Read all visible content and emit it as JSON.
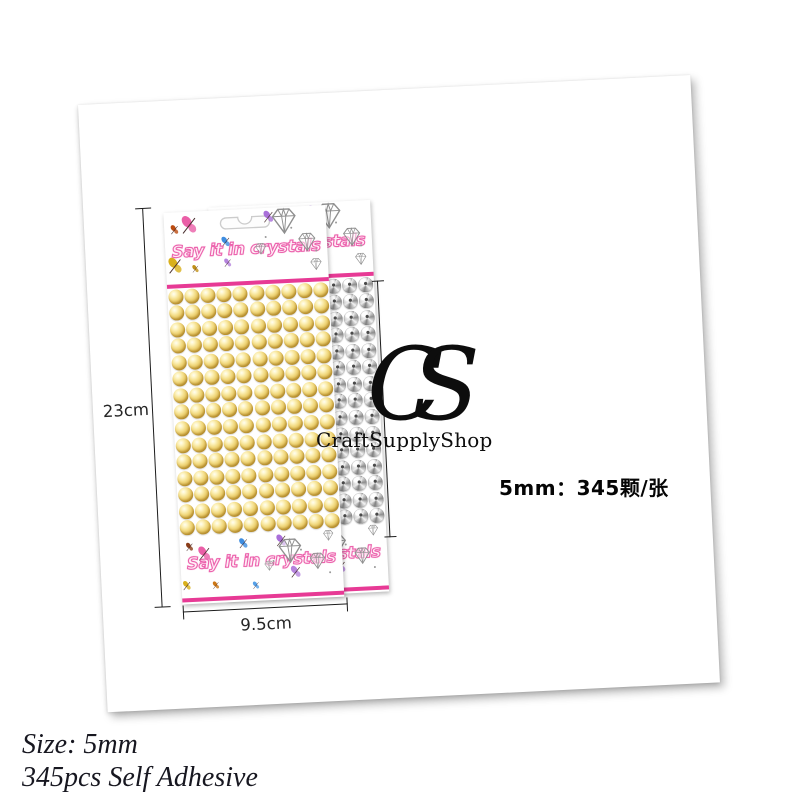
{
  "product_photo": {
    "brand_title": "Say it in crystals",
    "front_card": {
      "pearl_style": "gold",
      "grid": {
        "rows": 15,
        "cols": 10
      }
    },
    "back_card": {
      "pearl_style": "silver",
      "grid": {
        "rows": 15,
        "cols": 10
      }
    },
    "measurements": {
      "height": "23cm",
      "width": "9.5cm"
    },
    "watermark": {
      "monogram": "CS",
      "name": "CraftSupplyShop"
    },
    "spec_label": "5mm：345颗/张"
  },
  "caption": {
    "line1": "Size: 5mm",
    "line2": "345pcs Self Adhesive"
  },
  "colors": {
    "stripe_pink": "#e73a95",
    "title_pink": "#ec63ad",
    "gold_pearl": "#ddb84e",
    "silver_pearl": "#9b9b9b",
    "watermark_black": "#0d0d0d",
    "measure_line": "#1c1c1c"
  },
  "icon_names": [
    "butterfly-icon",
    "diamond-icon",
    "hang-hole-icon",
    "pearl"
  ]
}
